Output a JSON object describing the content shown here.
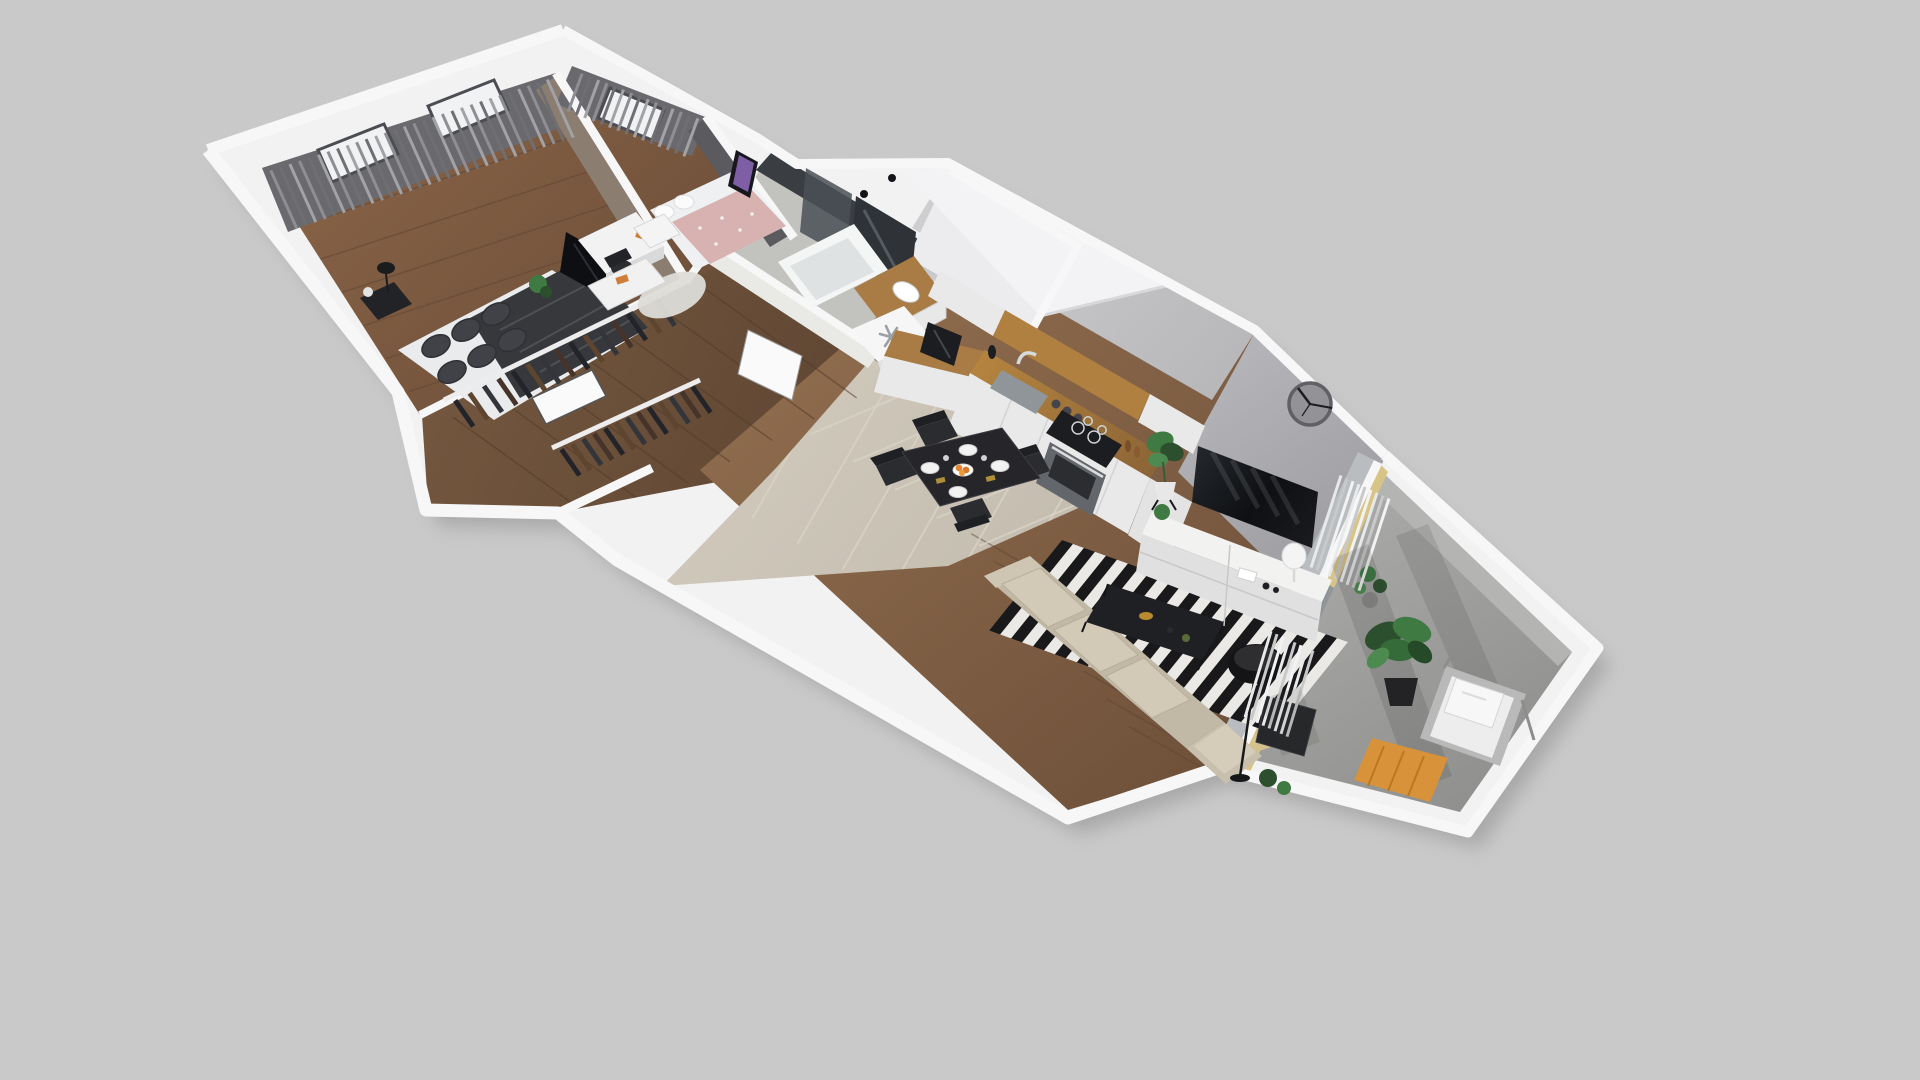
{
  "meta": {
    "type": "3d-apartment-floorplan-render",
    "background": "#c9c9ca",
    "view": "axonometric-cutaway"
  },
  "palette": {
    "wallTop": "#f7f7f8",
    "wallShell": "#f2f2f3",
    "shadow": "#8e8e8e",
    "curtainBase": "#6a6a6e",
    "taupeWall": "#8b7d70",
    "darkAccentWall": "#5a5a5f",
    "bathDarkTile": "#3a3d42",
    "bathWhiteTile": "#e9e9e6",
    "bathFloor": "#c2c2bf",
    "shaftTop": "#ececee",
    "shaftFace": "#cacace",
    "slab": "#f3f3f5",
    "kitchenWall": "#c6c6c9",
    "livingWall": "#aeaeb3",
    "glassWall": "#b9bdbf",
    "cabinetWhite": "#e9e9ea",
    "counterWood": "#a87c44",
    "accentWood": "#b08040",
    "ovenSteel": "#63666a",
    "applianceDark": "#1c1d21",
    "fridgeTop": "#f6f6f6",
    "tileFloor": "#ccc5b8",
    "grout": "#d9d3c6",
    "woodLivingA": "#8d6a4c",
    "woodLivingB": "#6b4e38",
    "woodMasterA": "#8a6548",
    "woodMasterB": "#6e4f39",
    "woodHallA": "#74573f",
    "woodHallB": "#5c4431",
    "rugBlack": "#19191b",
    "rugWhite": "#eae9e5",
    "sofaBeige": "#c2b8a6",
    "sofaCushion": "#d3c9b7",
    "armchairDark": "#26272b",
    "tableDark": "#26262a",
    "chairDark": "#2b2c30",
    "tvScreen": "#15171c",
    "sideboard": "#f2f2f1",
    "clockFace": "#939397",
    "clockRim": "#606065",
    "clockHands": "#1c1d1f",
    "plantGreen": "#3e7a42",
    "plantDark": "#2c4f2e",
    "balconyFloorA": "#ababa9",
    "balconyFloorB": "#8f8f8d",
    "creamWall": "#d9c488",
    "outdoorTable": "#d8923a",
    "loungeCushion": "#ededee",
    "bedBlanketDark": "#36383c",
    "bedSheet": "#e9ebec",
    "pillowGray": "#404247",
    "bedPink": "#d8b2b0",
    "fluffyRug": "#dddcd7",
    "doorWhite": "#fafafa",
    "snowflake": "#9aa0a6",
    "posterPurple": "#7e5fa6"
  },
  "icons": {
    "snowflake": "snowflake-icon",
    "clock": "wall-clock"
  },
  "rooms": [
    {
      "id": "master-bedroom",
      "furniture": [
        "double-bed",
        "pillows",
        "nightstand",
        "table-lamp",
        "wardrobe-rack",
        "tv-panel",
        "curtains",
        "windows",
        "door-panel"
      ]
    },
    {
      "id": "second-bedroom",
      "furniture": [
        "single-bed",
        "nightstand",
        "desk",
        "desk-chair",
        "poster",
        "fluffy-rug",
        "curtains",
        "window",
        "plant"
      ]
    },
    {
      "id": "bathroom",
      "furniture": [
        "bathtub",
        "vanity-sink",
        "mirror",
        "shower-glass",
        "wall-lamps",
        "washing-machine",
        "door"
      ]
    },
    {
      "id": "hallway",
      "furniture": [
        "wardrobe-rack",
        "dresser",
        "door-panel"
      ]
    },
    {
      "id": "kitchen",
      "furniture": [
        "fridge-column",
        "coffee-machine",
        "sink",
        "faucet",
        "induction-hob",
        "oven",
        "upper-cabinets",
        "wood-accent-panel",
        "spice-jars",
        "pepper-mills"
      ]
    },
    {
      "id": "dining-area",
      "furniture": [
        "dining-table",
        "dining-chairs",
        "plates",
        "fruit-bowl"
      ]
    },
    {
      "id": "living-room",
      "furniture": [
        "striped-rug",
        "corner-sofa",
        "armchair",
        "coffee-table",
        "floor-lamp",
        "tv",
        "tv-sideboard",
        "table-lamp",
        "wall-clock",
        "plants",
        "sheer-curtains",
        "balcony-door"
      ]
    },
    {
      "id": "balcony",
      "furniture": [
        "large-plant",
        "lounge-chair",
        "outdoor-table",
        "small-plants"
      ]
    }
  ],
  "clock": {
    "center": [
      1310,
      404
    ],
    "radius": 21
  },
  "procedural": {
    "rug": {
      "origin": [
        1062,
        540
      ],
      "u": [
        286,
        102
      ],
      "v": [
        -74,
        92
      ],
      "stripes": 26,
      "colors": [
        "#19191b",
        "#eae9e5"
      ]
    },
    "stroke_sets": [
      {
        "id": "curtain-master",
        "from": [
          266,
          172
        ],
        "to": [
          552,
          78
        ],
        "drop": [
          26,
          58
        ],
        "count": 30,
        "width": 3,
        "colors": [
          "#8f8f93",
          "#6f6f73",
          "#a3a3a7"
        ]
      },
      {
        "id": "curtain-bed2",
        "from": [
          578,
          72
        ],
        "to": [
          702,
          120
        ],
        "drop": [
          -14,
          38
        ],
        "count": 15,
        "width": 3,
        "colors": [
          "#8f8f93",
          "#6f6f73",
          "#a3a3a7"
        ]
      },
      {
        "id": "curtain-balcony1",
        "from": [
          1338,
          474
        ],
        "to": [
          1392,
          500
        ],
        "drop": [
          -30,
          92
        ],
        "count": 9,
        "width": 3,
        "colors": [
          "#e8e9ea",
          "#c8c9cb",
          "#f2f3f4"
        ]
      },
      {
        "id": "curtain-balcony2",
        "from": [
          1268,
          630
        ],
        "to": [
          1316,
          652
        ],
        "drop": [
          -26,
          86
        ],
        "count": 8,
        "width": 3,
        "colors": [
          "#e8e9ea",
          "#c8c9cb",
          "#f2f3f4"
        ]
      },
      {
        "id": "clothes-master",
        "from": [
          448,
          404
        ],
        "to": [
          664,
          296
        ],
        "drop": [
          18,
          26
        ],
        "count": 15,
        "width": 5,
        "colors": [
          "#23242a",
          "#5d4530",
          "#34353b",
          "#46332a"
        ]
      },
      {
        "id": "clothes-hall",
        "from": [
          556,
          452
        ],
        "to": [
          698,
          384
        ],
        "drop": [
          18,
          26
        ],
        "count": 13,
        "width": 5,
        "colors": [
          "#23242a",
          "#5d4530",
          "#34353b",
          "#46332a"
        ]
      },
      {
        "id": "planks-living",
        "from": [
          960,
          520
        ],
        "to": [
          1140,
          740
        ],
        "drop": [
          300,
          170
        ],
        "count": 8,
        "width": 1.5,
        "colors": [
          "#5f4532"
        ]
      },
      {
        "id": "planks-master",
        "from": [
          286,
          210
        ],
        "to": [
          420,
          408
        ],
        "drop": [
          300,
          -98
        ],
        "count": 6,
        "width": 1.5,
        "colors": [
          "#5f4532"
        ]
      },
      {
        "id": "planks-hall",
        "from": [
          432,
          428
        ],
        "to": [
          770,
          258
        ],
        "drop": [
          150,
          108
        ],
        "count": 8,
        "width": 1.5,
        "colors": [
          "#4f3a2a"
        ]
      },
      {
        "id": "grout-a",
        "from": [
          790,
          420
        ],
        "to": [
          1000,
          560
        ],
        "drop": [
          300,
          -128
        ],
        "count": 5,
        "width": 2,
        "colors": [
          "#d9d3c6"
        ]
      },
      {
        "id": "grout-b",
        "from": [
          850,
          295
        ],
        "to": [
          1120,
          450
        ],
        "drop": [
          -120,
          210
        ],
        "count": 6,
        "width": 2,
        "colors": [
          "#d9d3c6"
        ]
      }
    ]
  }
}
